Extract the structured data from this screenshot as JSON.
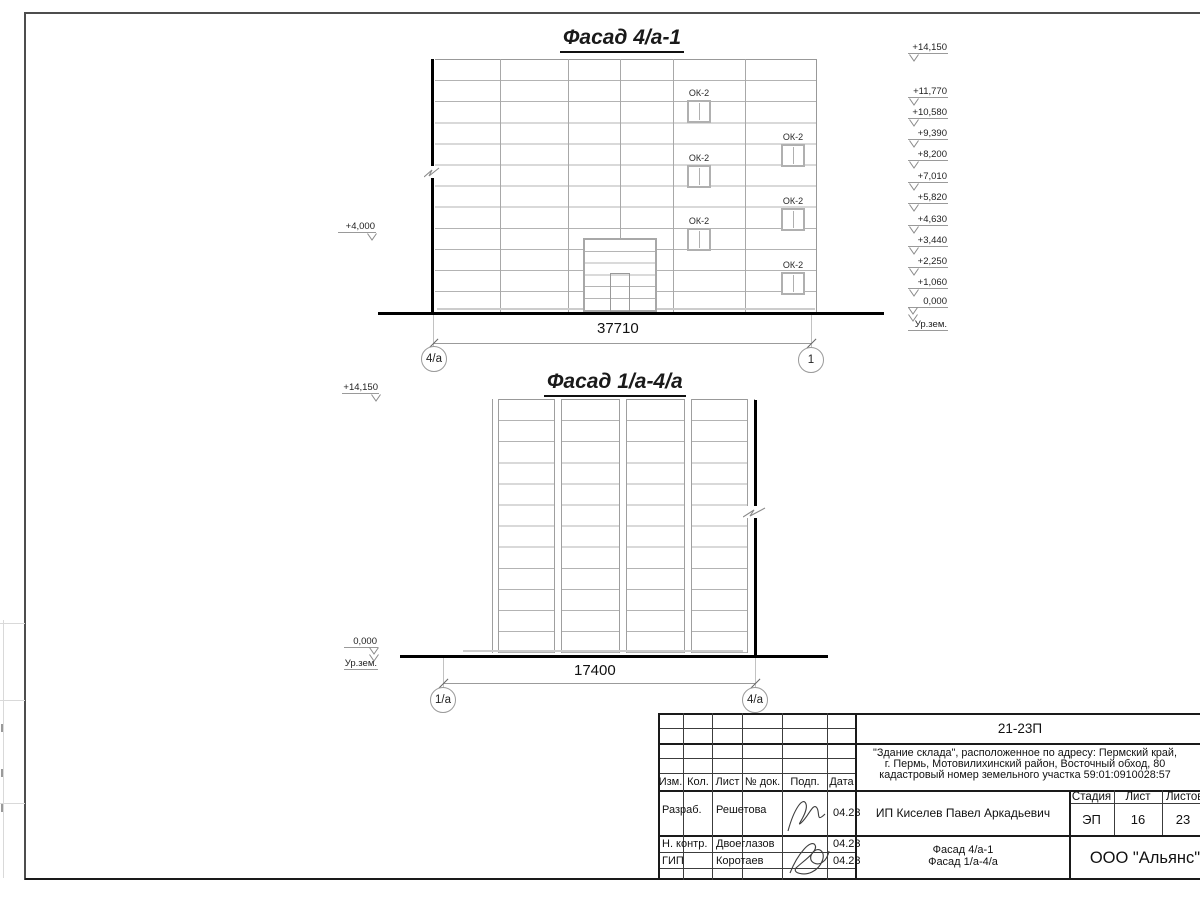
{
  "drawing": {
    "facade1": {
      "title": "Фасад 4/а-1",
      "dimension": "37710",
      "axis_left": "4/а",
      "axis_right": "1",
      "left_elevation": "+4,000",
      "window_label": "ОК-2",
      "elevations": [
        "+14,150",
        "+11,770",
        "+10,580",
        "+9,390",
        "+8,200",
        "+7,010",
        "+5,820",
        "+4,630",
        "+3,440",
        "+2,250",
        "+1,060",
        "0,000"
      ],
      "ground_level_label": "Ур.зем."
    },
    "facade2": {
      "title": "Фасад 1/а-4/а",
      "dimension": "17400",
      "axis_left": "1/а",
      "axis_right": "4/а",
      "top_elevation": "+14,150",
      "zero_elevation": "0,000",
      "ground_level_label": "Ур.зем."
    }
  },
  "title_block": {
    "project_code": "21-23П",
    "description_line1": "\"Здание склада\", расположенное по адресу: Пермский край,",
    "description_line2": "г. Пермь, Мотовилихинский район, Восточный обход, 80",
    "description_line3": "кадастровый номер земельного участка 59:01:0910028:57",
    "client": "ИП Киселев Павел Аркадьевич",
    "sheet_title_line1": "Фасад 4/а-1",
    "sheet_title_line2": "Фасад 1/а-4/а",
    "organization": "ООО \"Альянс\"",
    "col_izm": "Изм.",
    "col_kol": "Кол.",
    "col_list": "Лист",
    "col_dok": "№ док.",
    "col_podp": "Подп.",
    "col_data": "Дата",
    "stage_label": "Стадия",
    "sheet_label": "Лист",
    "sheets_label": "Листов",
    "stage_value": "ЭП",
    "sheet_value": "16",
    "sheets_value": "23",
    "roles": [
      {
        "role": "Разраб.",
        "name": "Решетова",
        "date": "04.23"
      },
      {
        "role": "Н. контр.",
        "name": "Двоеглазов",
        "date": "04.23"
      },
      {
        "role": "ГИП",
        "name": "Коротаев",
        "date": "04.23"
      }
    ]
  }
}
